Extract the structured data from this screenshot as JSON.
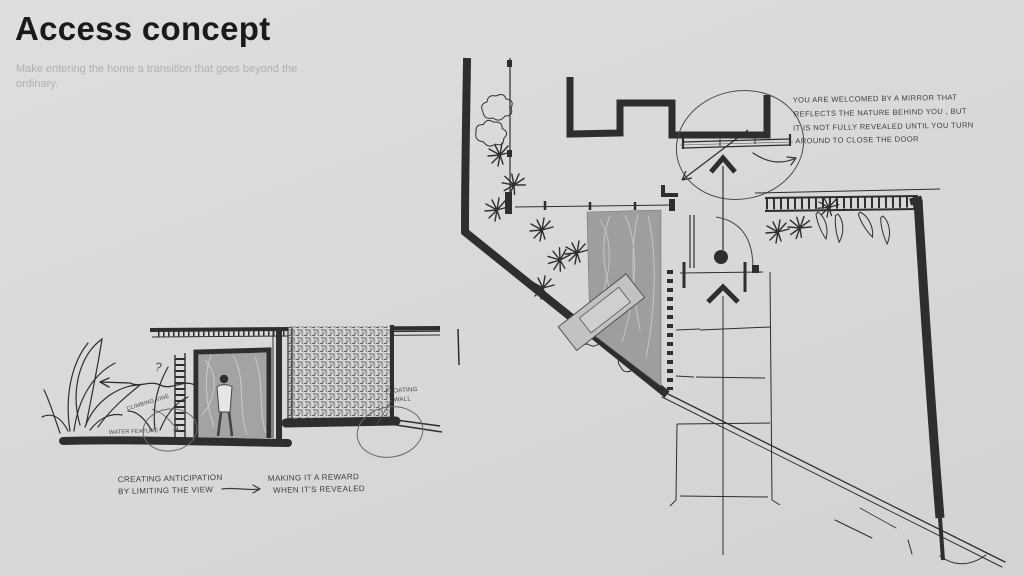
{
  "page": {
    "background": "#d9d9d9",
    "ink": "#2e2e2e",
    "gray_fill": "#9e9e9e",
    "title_color": "#1b1b1b",
    "subtitle_color": "#b0b0b0"
  },
  "header": {
    "title": "Access concept",
    "subtitle": "Make entering the home a transition that goes beyond the ordinary."
  },
  "plan_note": {
    "line1": "YOU ARE WELCOMED BY A MIRROR THAT",
    "line2": "REFLECTS THE NATURE BEHIND YOU , BUT",
    "line3": "IT IS NOT FULLY REVEALED UNTIL YOU TURN",
    "line4": "AROUND TO CLOSE THE DOOR"
  },
  "elevation_labels": {
    "climbing_vine": "CLIMBING VINE",
    "water_feature": "WATER FEATURE",
    "floating_wall_line1": "FLOATING",
    "floating_wall_line2": "WALL",
    "question_mark": "?"
  },
  "captions": {
    "left_line1": "CREATING ANTICIPATION",
    "left_line2": "BY LIMITING THE VIEW",
    "right_line1": "MAKING IT A REWARD",
    "right_line2": "WHEN IT'S REVEALED"
  }
}
